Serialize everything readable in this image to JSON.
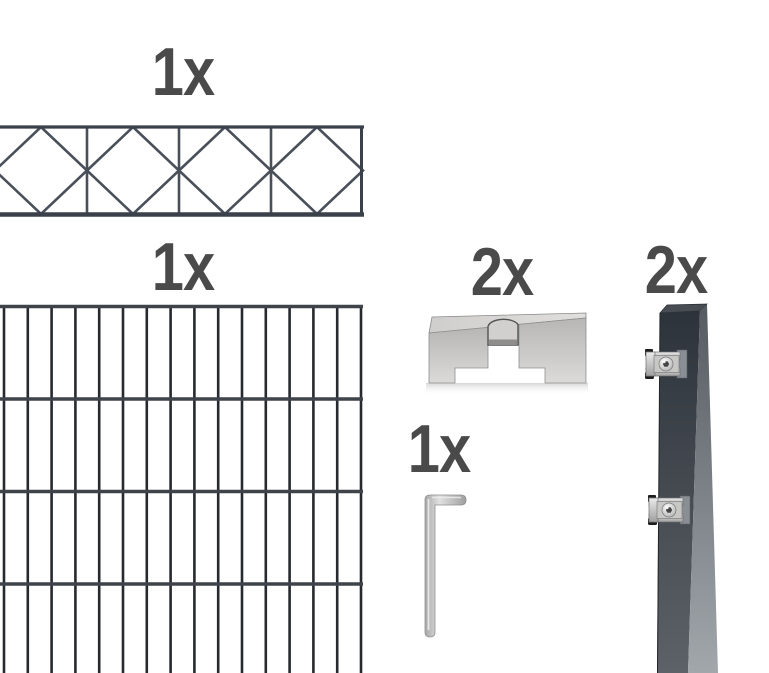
{
  "figure": {
    "kind": "fence-kit-contents",
    "background": "#ffffff",
    "label_color": "#4a4a4a",
    "items": [
      {
        "name": "decorative-top-panel",
        "quantity": "1x"
      },
      {
        "name": "double-rod-mesh-panel",
        "quantity": "1x"
      },
      {
        "name": "cover-bracket",
        "quantity": "2x"
      },
      {
        "name": "allen-key",
        "quantity": "1x"
      },
      {
        "name": "anthracite-post-with-clamps",
        "quantity": "2x"
      }
    ],
    "colors": {
      "decor_wire": "#49505a",
      "decor_rail": "#3b414a",
      "mesh_wire_vertical": "#26292e",
      "mesh_wire_horizontal": "#3e444a",
      "post_dark": "#2d333a",
      "post_light": "#a2a7ac",
      "metal_light": "#c9c9c9",
      "shadow": "#e2e2e2"
    }
  }
}
